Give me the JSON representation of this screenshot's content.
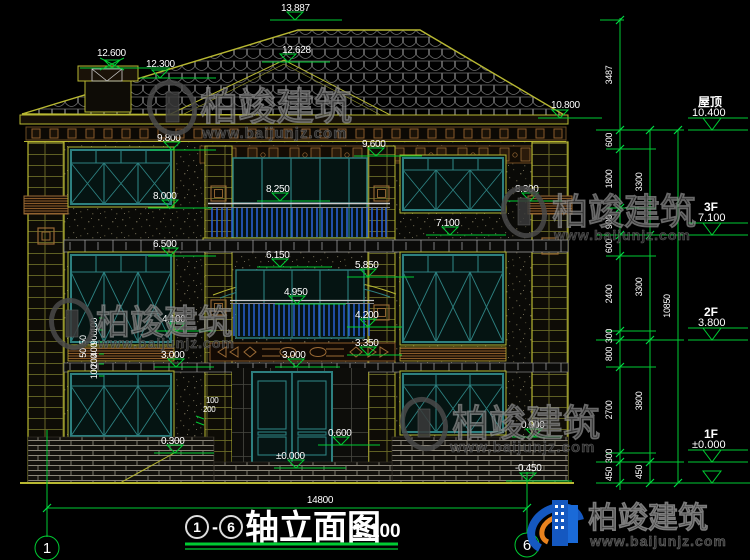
{
  "watermark": {
    "brand": "柏竣建筑",
    "url": "www.baijunjz.com"
  },
  "title": {
    "axis_from": "1",
    "dash": "-",
    "axis_to": "6",
    "name": "轴立面图",
    "scale": "1:100"
  },
  "axes": {
    "left": "1",
    "right": "6"
  },
  "dims": {
    "total_width": "14800",
    "chain_inner": [
      "3487",
      "600",
      "1800",
      "900",
      "600",
      "2400",
      "300",
      "800",
      "2700",
      "300",
      "450"
    ],
    "chain_middle": [
      "3300",
      "3300",
      "3800",
      "450"
    ],
    "chain_outer": [
      "10850"
    ],
    "left_col_a": [
      "50",
      "50"
    ],
    "left_col_b": [
      "100",
      "900",
      "400",
      "200",
      "100"
    ],
    "door_a": "100",
    "door_b": "200"
  },
  "floors": [
    {
      "name": "屋顶",
      "level": "10.400"
    },
    {
      "name": "3F",
      "level": "7.100"
    },
    {
      "name": "2F",
      "level": "3.800"
    },
    {
      "name": "1F",
      "level": "±0.000"
    }
  ],
  "markers": {
    "peak": "13.887",
    "bay": "12.628",
    "chim_hi": "12.600",
    "chim_lo": "12.300",
    "eave": "10.800",
    "m9800": "9.800",
    "m9600": "9.600",
    "m8250": "8.250",
    "m8300": "8.300",
    "m8000": "8.000",
    "m7100": "7.100",
    "m6500": "6.500",
    "m6150": "6.150",
    "m5850": "5.850",
    "m4950": "4.950",
    "m4200": "4.200",
    "m4100": "4.100",
    "m3350": "3.350",
    "m3000l": "3.000",
    "m3000c": "3.000",
    "m0900": "0.900",
    "m0600": "0.600",
    "m0300": "0.300",
    "zero": "±0.000",
    "minus450": "-0.450"
  },
  "colors": {
    "dim_green": "#00cc33",
    "line_yellow": "#b8b832",
    "teal": "#2d8080",
    "brown": "#8a5a2a",
    "rail_blue": "#2a5fd0",
    "logo_blue": "#1558c0",
    "logo_orange": "#e8821e"
  }
}
